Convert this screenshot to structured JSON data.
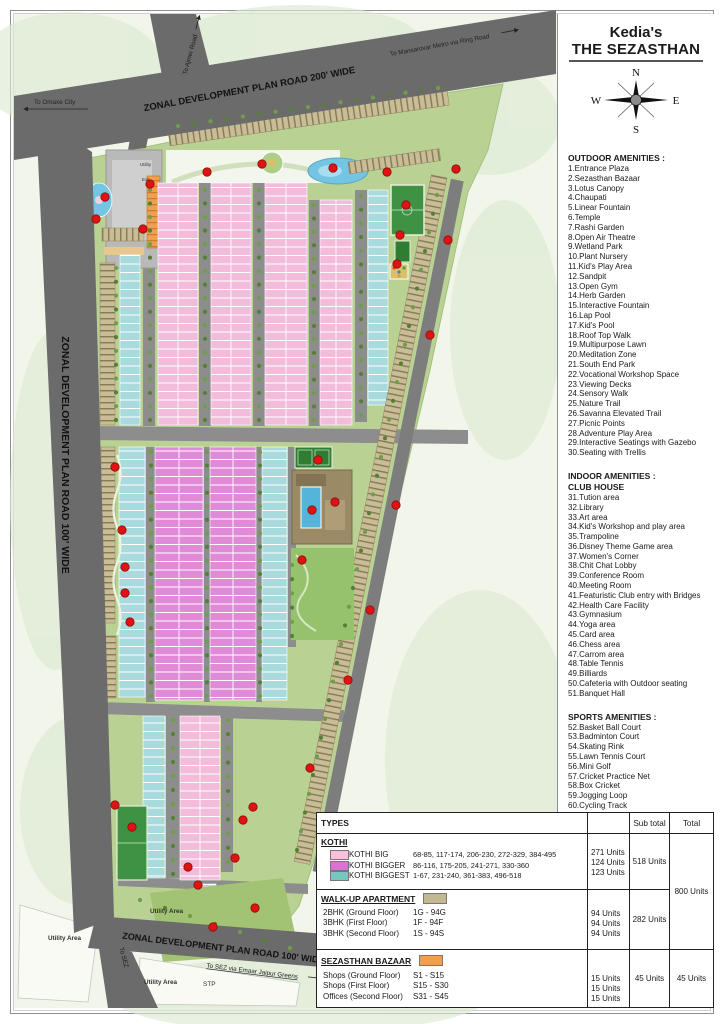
{
  "title": {
    "brand": "Kedia's",
    "name": "THE SEZASTHAN"
  },
  "compass": {
    "n": "N",
    "s": "S",
    "e": "E",
    "w": "W"
  },
  "amenities": {
    "sections": [
      {
        "headings": [
          "OUTDOOR AMENITIES :"
        ],
        "items": [
          "1.Entrance Plaza",
          "2.Sezasthan Bazaar",
          "3.Lotus Canopy",
          "4.Chaupati",
          "5.Linear Fountain",
          "6.Temple",
          "7.Rashi Garden",
          "8.Open Air Theatre",
          "9.Wetland Park",
          "10.Plant Nursery",
          "11.Kid's Play Area",
          "12.Sandpit",
          "13.Open Gym",
          "14.Herb Garden",
          "15.Interactive Fountain",
          "16.Lap Pool",
          "17.Kid's Pool",
          "18.Roof Top Walk",
          "19.Multipurpose Lawn",
          "20.Meditation Zone",
          "21.South End Park",
          "22.Vocational Workshop Space",
          "23.Viewing Decks",
          "24.Sensory Walk",
          "25.Nature Trail",
          "26.Savanna Elevated Trail",
          "27.Picnic Points",
          "28.Adventure Play Area",
          "29.Interactive Seatings with Gazebo",
          "30.Seating with Trellis"
        ]
      },
      {
        "headings": [
          "INDOOR AMENITIES :",
          "CLUB HOUSE"
        ],
        "items": [
          "31.Tution area",
          "32.Library",
          "33.Art area",
          "34.Kid's Workshop and play area",
          "35.Trampoline",
          "36.Disney Theme Game area",
          "37.Women's Corner",
          "38.Chit Chat Lobby",
          "39.Conference Room",
          "40.Meeting Room",
          "41.Featuristic Club entry with Bridges",
          "42.Health Care Facility",
          "43.Gymnasium",
          "44.Yoga area",
          "45.Card area",
          "46.Chess area",
          "47.Carrom area",
          "48.Table Tennis",
          "49.Billiards",
          "50.Cafeteria with Outdoor seating",
          "51.Banquet Hall"
        ]
      },
      {
        "headings": [
          "SPORTS AMENITIES :"
        ],
        "items": [
          "52.Basket Ball Court",
          "53.Badminton Court",
          "54.Skating Rink",
          "55.Lawn Tennis Court",
          "56.Mini Golf",
          "57.Cricket Practice Net",
          "58.Box Cricket",
          "59.Jogging Loop",
          "60.Cycling Track"
        ]
      }
    ]
  },
  "map": {
    "roads": {
      "top": "ZONAL DEVELOPMENT PLAN ROAD 200' WIDE",
      "left": "ZONAL DEVELOPMENT PLAN ROAD 100' WIDE",
      "bottom": "ZONAL DEVELOPMENT PLAN ROAD 100' WIDE"
    },
    "directions": {
      "ajmer": "To Ajmer Road",
      "omaxe": "To Omaxe City",
      "mansarovar": "To Mansarovar Metro via Ring Road",
      "sez": "To SEZ",
      "sez_via": "To SEZ via Emaar Jaipur Greens"
    },
    "areas": {
      "utility": "Utility Area",
      "stp": "STP",
      "utility_small": "Utility",
      "exit": "Exit"
    },
    "colors": {
      "road": "#6b6b6b",
      "site_green": "#b9d294",
      "kothi_big_map": "#f3bcdb",
      "kothi_bigger_map": "#e18ad8",
      "kothi_biggest_map": "#a9dade",
      "apartment_tan": "#c9bd97",
      "bazaar_orange": "#ef9f4d",
      "water": "#74c4e4",
      "marker_red": "#e01212"
    }
  },
  "table": {
    "header": {
      "types": "TYPES",
      "sub_total": "Sub total",
      "total": "Total"
    },
    "kothi": {
      "title": "KOTHI",
      "rows": [
        {
          "color": "#f6c2da",
          "label": "KOTHI BIG",
          "ranges": "68-85, 117-174, 206-230, 272-329, 384-495",
          "units": "271 Units"
        },
        {
          "color": "#e06ed4",
          "label": "KOTHI BIGGER",
          "ranges": "86-116, 175-205, 241-271, 330-360",
          "units": "124 Units"
        },
        {
          "color": "#74c8c0",
          "label": "KOTHI BIGGEST",
          "ranges": "1-67, 231-240, 361-383, 496-518",
          "units": "123 Units"
        }
      ],
      "sub_total": "518 Units"
    },
    "walkup": {
      "title": "WALK-UP APARTMENT",
      "color": "#c3b88f",
      "rows": [
        {
          "label": "2BHK (Ground Floor)",
          "range": "1G - 94G",
          "units": "94 Units"
        },
        {
          "label": "3BHK (First Floor)",
          "range": "1F - 94F",
          "units": "94 Units"
        },
        {
          "label": "3BHK (Second Floor)",
          "range": "1S - 94S",
          "units": "94 Units"
        }
      ],
      "sub_total": "282 Units"
    },
    "bazaar": {
      "title": "SEZASTHAN BAZAAR",
      "color": "#ef9f4d",
      "rows": [
        {
          "label": "Shops (Ground Floor)",
          "range": "S1 - S15",
          "units": "15 Units"
        },
        {
          "label": "Shops (First Floor)",
          "range": "S15 - S30",
          "units": "15 Units"
        },
        {
          "label": "Offices (Second Floor)",
          "range": "S31 - S45",
          "units": "15 Units"
        }
      ],
      "sub_total": "45 Units",
      "total": "45 Units"
    },
    "kothi_walkup_total": "800 Units"
  }
}
